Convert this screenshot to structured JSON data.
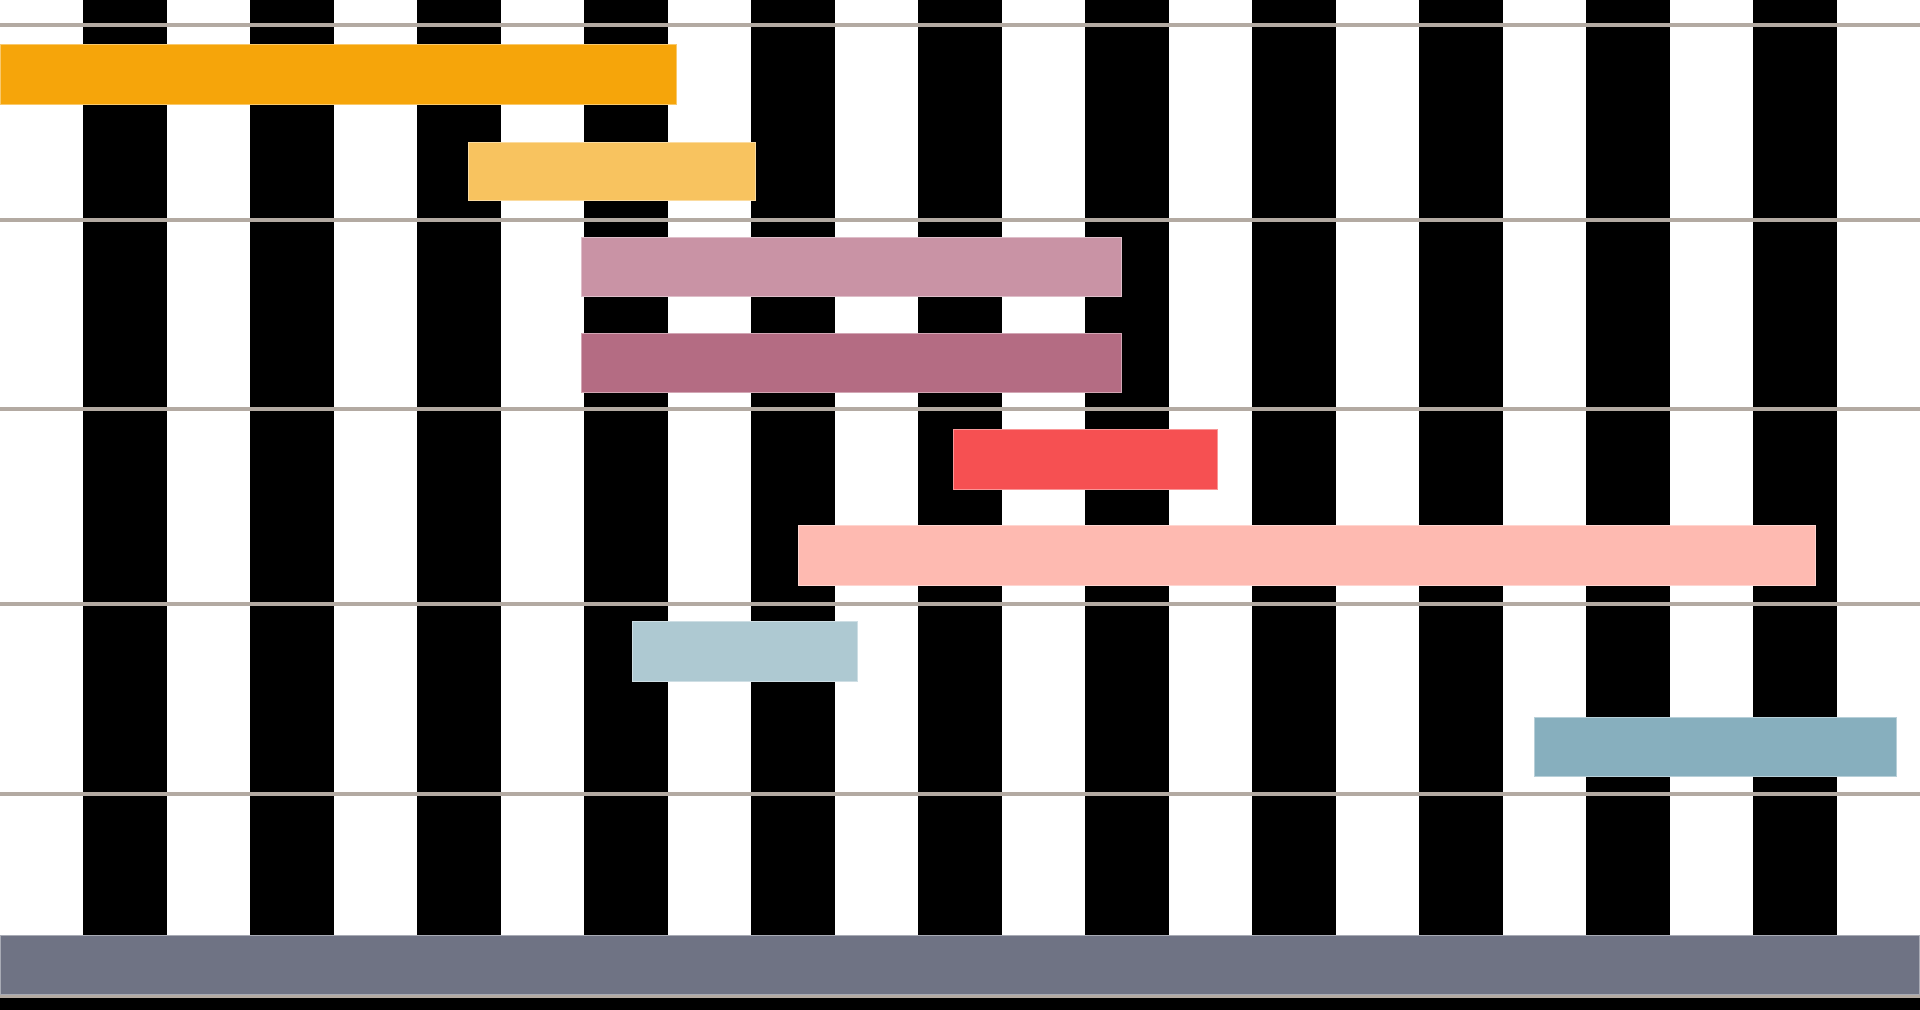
{
  "canvas": {
    "width_px": 1920,
    "height_px": 1010
  },
  "chart_data": {
    "type": "bar",
    "subtype": "gantt-timeline",
    "title": "",
    "xlabel": "",
    "ylabel": "",
    "legend": "none",
    "axis_labels_visible": false,
    "background_stripes": {
      "count": 23,
      "stripe_width_px": 83.478,
      "even_color": "#FFFFFF",
      "odd_color": "#000000",
      "orientation": "vertical",
      "note": "alternating white/black day columns, starts white at x=0, ends white at right edge"
    },
    "gridlines": {
      "color": "#B3AAA2",
      "thickness_px": 4,
      "y_positions_px": [
        23,
        218,
        407,
        602,
        792,
        994
      ],
      "note": "horizontal section separators, 5 sections of ~193px (2 task rows each)"
    },
    "x_axis": {
      "unit": "day-columns",
      "range_days": [
        0,
        23
      ],
      "px_per_day": 83.478
    },
    "bottom_margin_band": {
      "y_px": 998,
      "height_px": 12,
      "color": "#000000"
    },
    "tasks": [
      {
        "id": "task-1",
        "row": 0,
        "section": 1,
        "color": "#F6A50A",
        "x_px": 0,
        "width_px": 677,
        "y_px": 44,
        "height_px": 61,
        "start_day": 0.0,
        "end_day": 8.1
      },
      {
        "id": "task-2",
        "row": 1,
        "section": 1,
        "color": "#F8C35F",
        "x_px": 468,
        "width_px": 288,
        "y_px": 142,
        "height_px": 59,
        "start_day": 5.6,
        "end_day": 9.05
      },
      {
        "id": "task-3",
        "row": 2,
        "section": 2,
        "color": "#C993A5",
        "x_px": 581,
        "width_px": 541,
        "y_px": 237,
        "height_px": 60,
        "start_day": 6.96,
        "end_day": 13.44
      },
      {
        "id": "task-4",
        "row": 3,
        "section": 2,
        "color": "#B46C83",
        "x_px": 581,
        "width_px": 541,
        "y_px": 333,
        "height_px": 60,
        "start_day": 6.96,
        "end_day": 13.44
      },
      {
        "id": "task-5",
        "row": 4,
        "section": 3,
        "color": "#F65052",
        "x_px": 953,
        "width_px": 265,
        "y_px": 429,
        "height_px": 61,
        "start_day": 11.4,
        "end_day": 14.6
      },
      {
        "id": "task-6",
        "row": 5,
        "section": 3,
        "color": "#FEBAB1",
        "x_px": 798,
        "width_px": 1018,
        "y_px": 525,
        "height_px": 61,
        "start_day": 9.56,
        "end_day": 21.75
      },
      {
        "id": "task-7",
        "row": 6,
        "section": 4,
        "color": "#AEC9D2",
        "x_px": 632,
        "width_px": 226,
        "y_px": 621,
        "height_px": 61,
        "start_day": 7.57,
        "end_day": 10.28
      },
      {
        "id": "task-8",
        "row": 7,
        "section": 4,
        "color": "#87AFBE",
        "x_px": 1534,
        "width_px": 363,
        "y_px": 717,
        "height_px": 60,
        "start_day": 18.38,
        "end_day": 22.72
      },
      {
        "id": "task-9",
        "row": 9,
        "section": 5,
        "color": "#6F7384",
        "x_px": 0,
        "width_px": 1920,
        "y_px": 935,
        "height_px": 60,
        "start_day": 0.0,
        "end_day": 23.0
      }
    ]
  }
}
